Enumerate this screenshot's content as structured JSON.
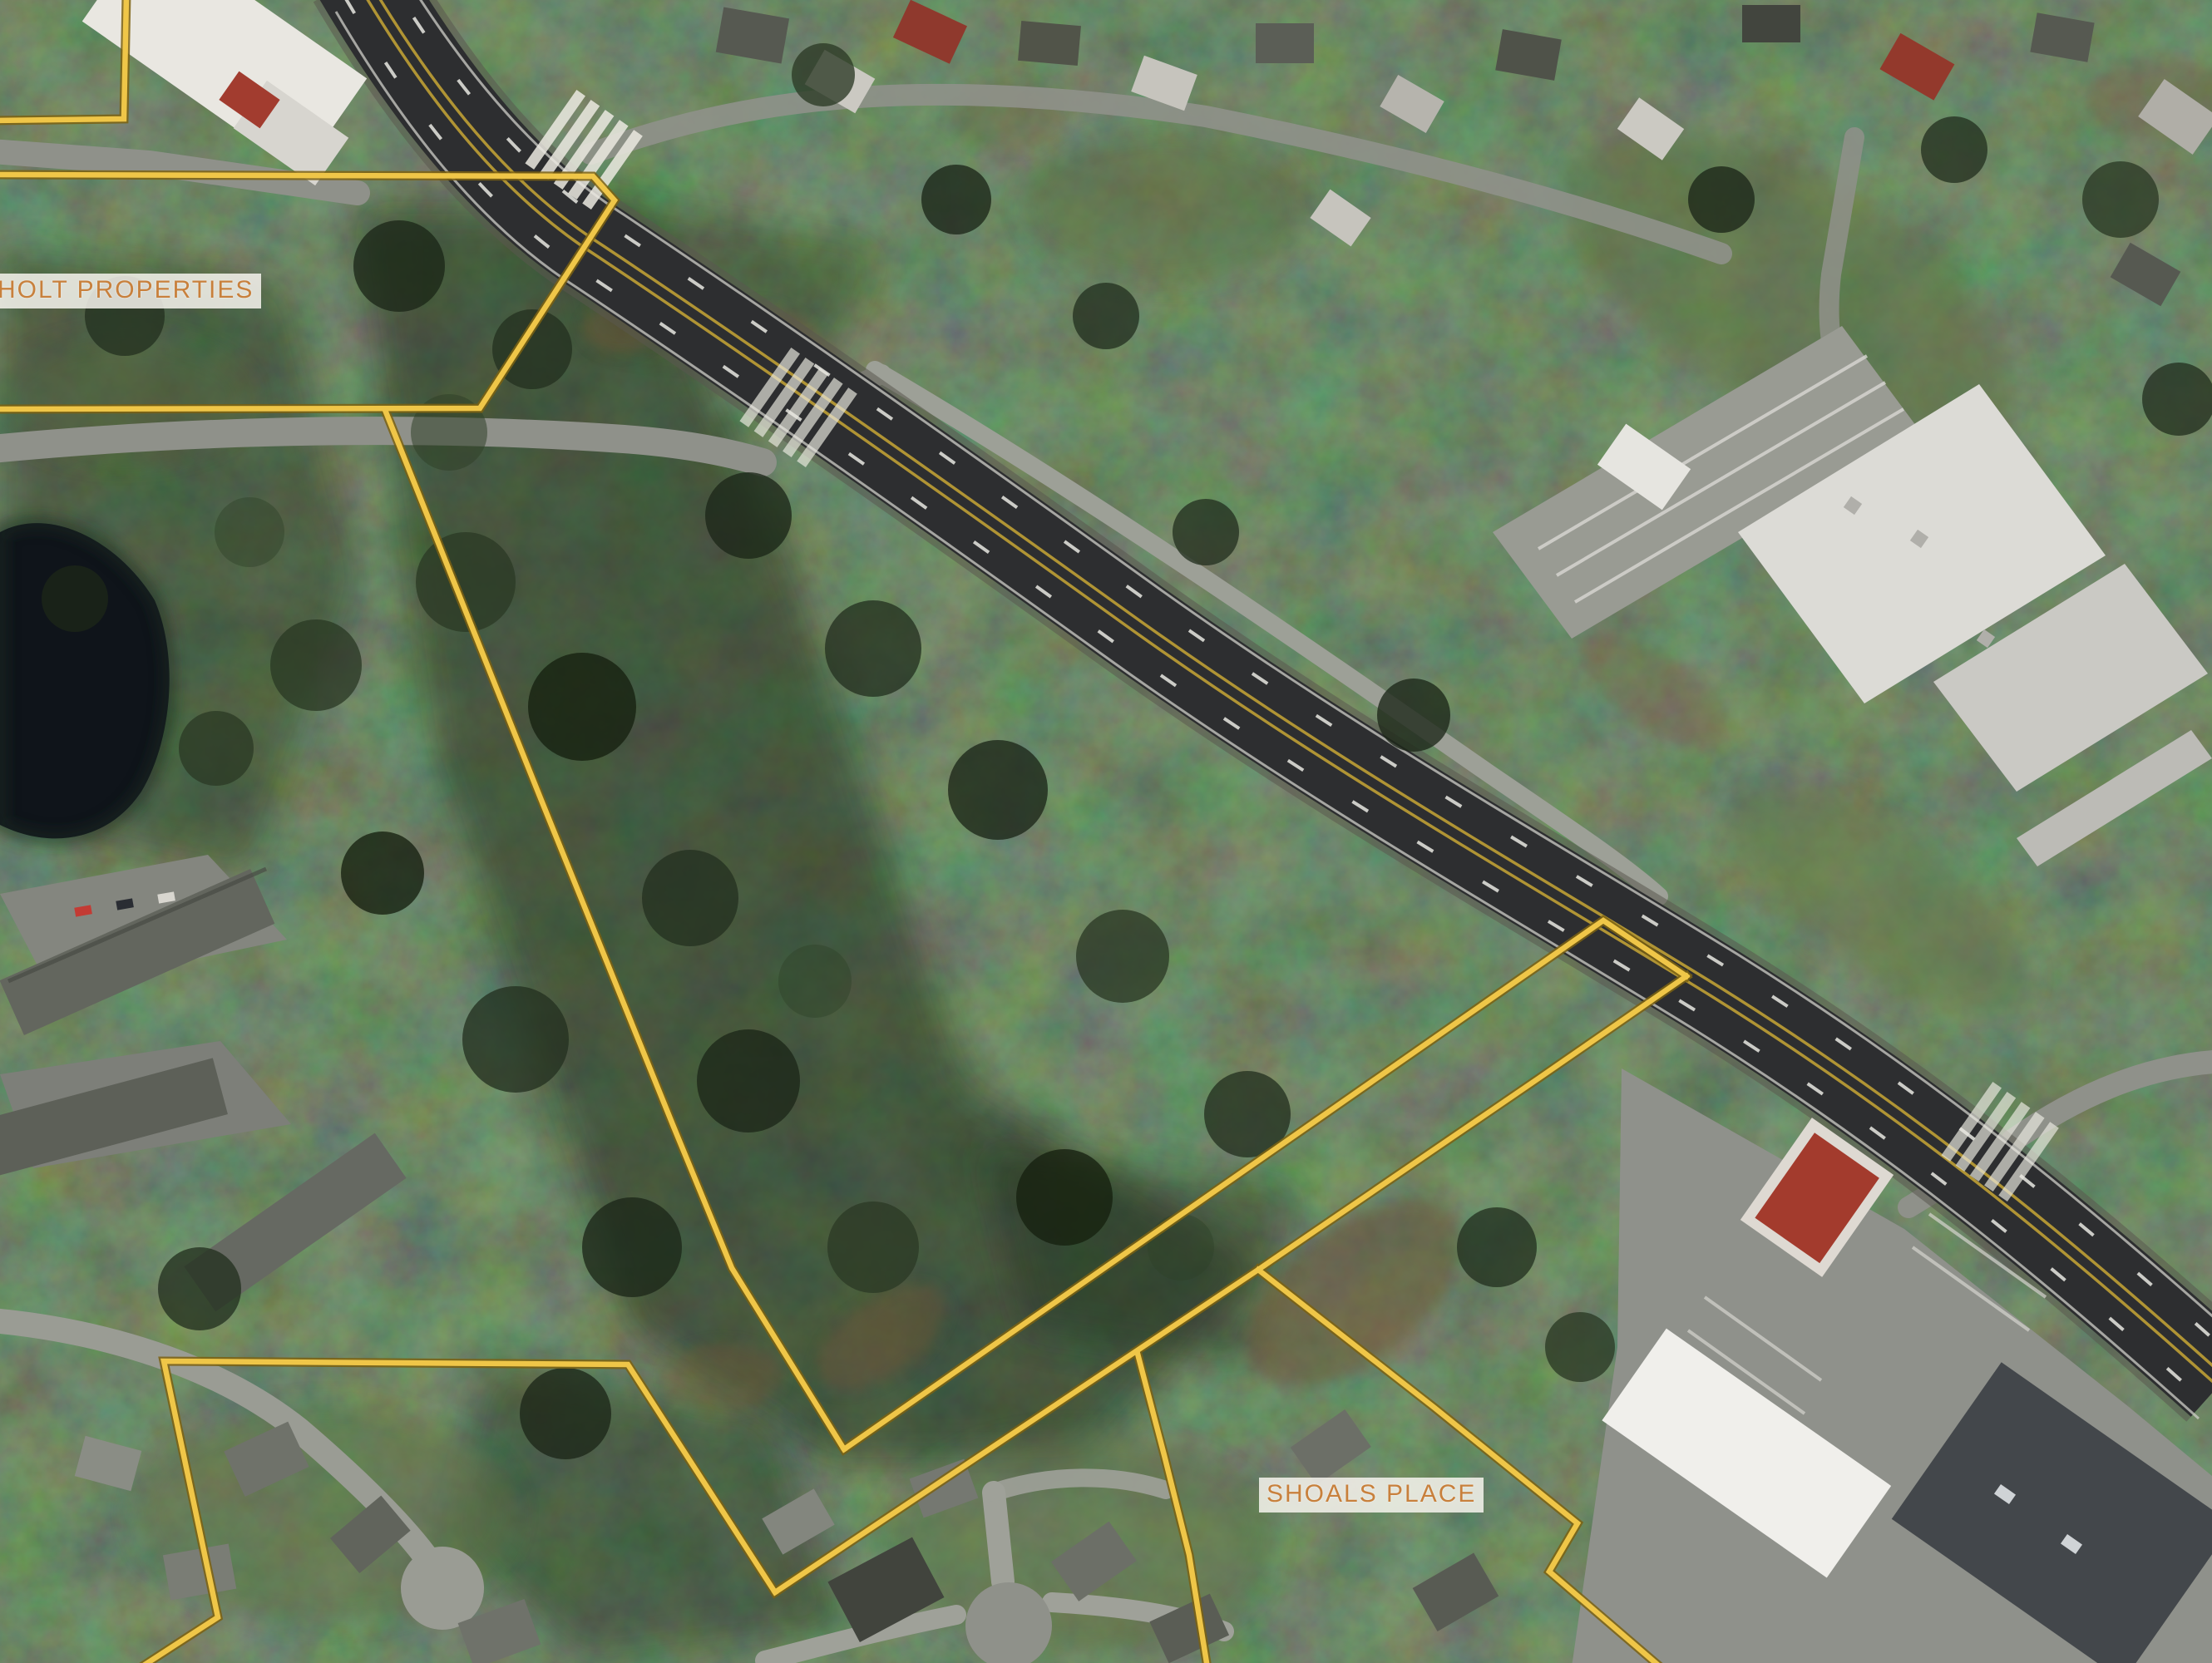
{
  "app": {
    "name": "parcel-map-satellite-view"
  },
  "map": {
    "background_type": "satellite-imagery",
    "parcels": {
      "line_color": "#efc648",
      "line_edge_color": "#7c6212",
      "labels": [
        {
          "id": "holt-properties",
          "text": "HOLT PROPERTIES"
        },
        {
          "id": "shoals-place",
          "text": "SHOALS PLACE"
        }
      ]
    },
    "label_style": {
      "text_color": "#c8803c",
      "bg_color": "rgba(247,244,238,0.85)"
    }
  }
}
